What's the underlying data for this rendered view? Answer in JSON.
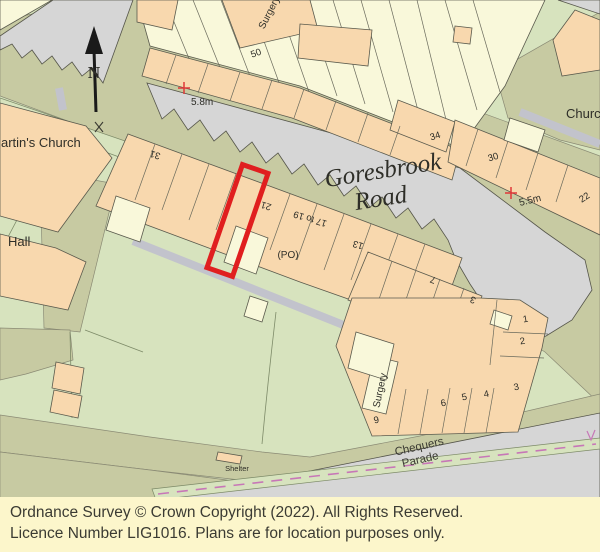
{
  "map": {
    "road_names": {
      "goresbrook_line1": "Goresbrook",
      "goresbrook_line2": "Road",
      "chequers_line1": "Chequers",
      "chequers_line2": "Parade"
    },
    "labels": {
      "martins_church": "artin's Church",
      "hall": "Hall",
      "church": "Church",
      "surgery_top": "Surgery",
      "surgery_bottom": "Surgery",
      "shelter": "Shelter",
      "post_office": "(PO)",
      "north": "N"
    },
    "spot_heights": {
      "h1": "5.8m",
      "h2": "5.5m"
    },
    "house_numbers": {
      "n50": "50",
      "n34": "34",
      "n30": "30",
      "n22": "22",
      "n31": "31",
      "n21": "21",
      "n17to19": "17 to 19",
      "n13": "13",
      "n7": "7",
      "n3_terrace": "3",
      "n1": "1",
      "n2": "2",
      "n3": "3",
      "n4": "4",
      "n5": "5",
      "n6": "6",
      "n9": "9"
    }
  },
  "colors": {
    "building_peach": "#F8D8AE",
    "building_cream": "#F9F8DA",
    "road_grey": "#D6D6D6",
    "road_verge_olive": "#C7CAA2",
    "open_land_green": "#D7E3BE",
    "footpath_grey": "#C2C3CC",
    "plot_outline_red": "#E01F1F",
    "spot_height_red": "#E03838",
    "cycle_dash_pink": "#C777B7",
    "footer_background": "#FCF6CB"
  },
  "footer": {
    "line1": "Ordnance Survey © Crown Copyright (2022).  All Rights Reserved.",
    "line2": "Licence Number LIG1016.  Plans are for location purposes only."
  }
}
